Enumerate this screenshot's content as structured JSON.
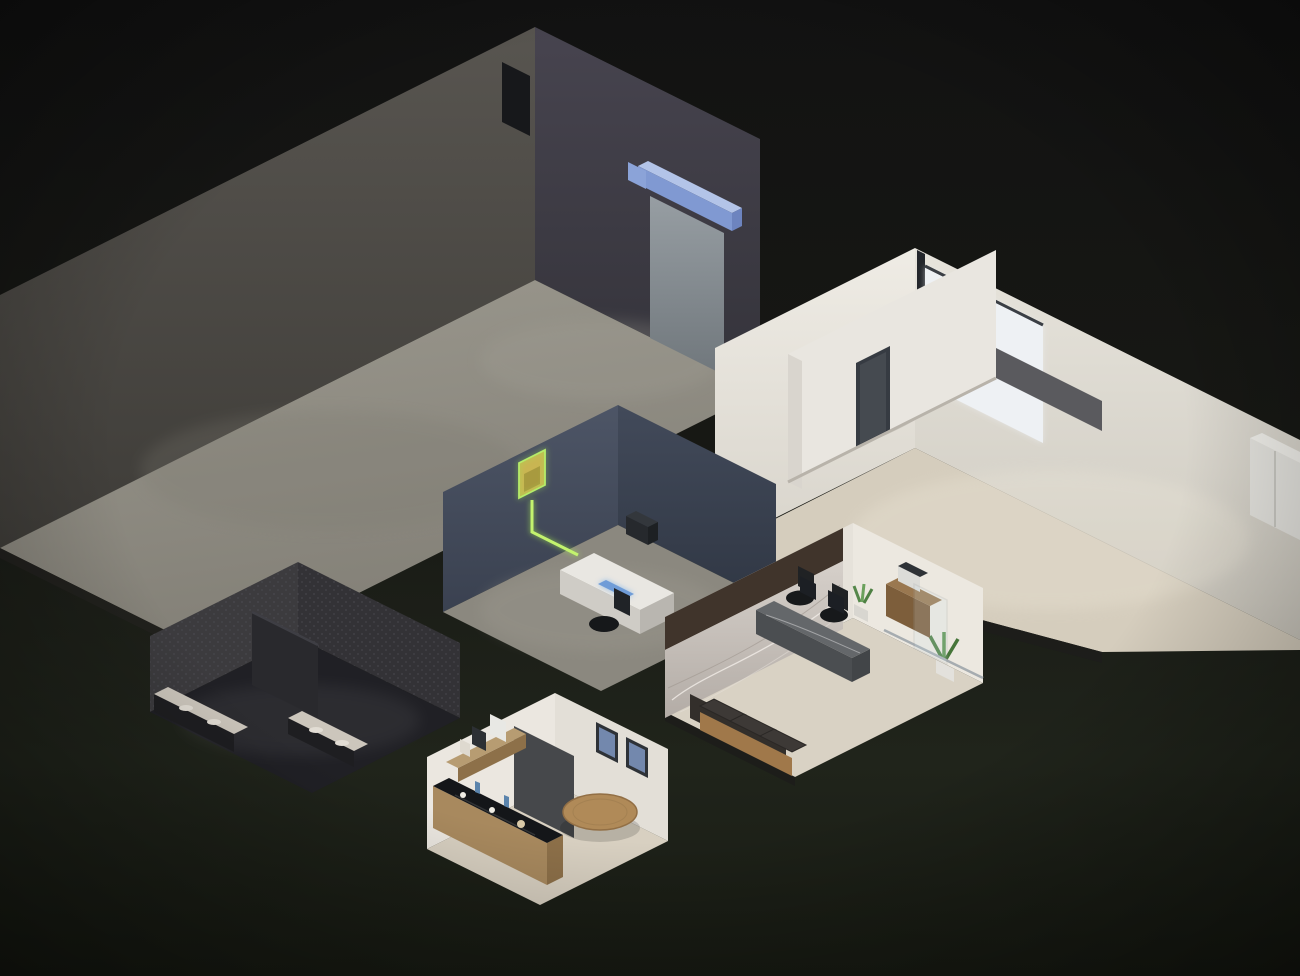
{
  "meta": {
    "type": "isometric-facility-illustration",
    "canvas": {
      "width": 1300,
      "height": 976
    },
    "description": "3D isometric cutaway of a connected facility: warehouse, open office, server room, restrooms, reception and break room linked by glowing green circuit traces on dark ground"
  },
  "palette": {
    "background_top": "#131313",
    "background_mid": "#1a1c16",
    "background_bottom": "#20241b",
    "accent": "#a8e063",
    "outline": "#b9ed6f",
    "trace": "#9fd84f",
    "led": "#f6f0de",
    "light_warm": "#ffefc4",
    "screen_blue": "#9cc8f4",
    "rack_blue": "#3c53b4",
    "rack_orange": "#c96f2d",
    "box_beige": "#c6b9a3",
    "concrete": "#918e85",
    "warehouse_wall": "#4c4a46",
    "office_wall": "#e9e6df",
    "office_floor": "#d5cdbd",
    "server_wall": "#454d5c",
    "cabinet_olive": "#7e8262",
    "bathroom_wall": "#3a393c",
    "bathroom_floor": "#202025",
    "marble_light": "#cdc7c1",
    "wood": "#a8895e",
    "sofa_leather": "#9f7446",
    "slat_brown": "#40342b",
    "door_blue": "#8099d2"
  },
  "rooms": [
    {
      "id": "warehouse",
      "label": "Warehouse",
      "closed": false,
      "outline": [
        [
          0,
          295
        ],
        [
          535,
          27
        ],
        [
          760,
          139
        ],
        [
          760,
          398
        ]
      ]
    },
    {
      "id": "office",
      "label": "Open office",
      "closed": false,
      "outline": [
        [
          790,
          584
        ],
        [
          715,
          548
        ],
        [
          715,
          348
        ],
        [
          915,
          248
        ],
        [
          1298,
          439
        ]
      ]
    },
    {
      "id": "server-room",
      "label": "Server room",
      "closed": true,
      "outline": [
        [
          618,
          405
        ],
        [
          776,
          484
        ],
        [
          776,
          604
        ],
        [
          601,
          691
        ],
        [
          443,
          612
        ],
        [
          443,
          492
        ]
      ]
    },
    {
      "id": "restrooms",
      "label": "Restrooms",
      "closed": true,
      "outline": [
        [
          298,
          562
        ],
        [
          460,
          643
        ],
        [
          460,
          718
        ],
        [
          312,
          793
        ],
        [
          150,
          712
        ],
        [
          150,
          636
        ]
      ]
    },
    {
      "id": "reception",
      "label": "Reception",
      "closed": true,
      "outline": [
        [
          853,
          523
        ],
        [
          983,
          588
        ],
        [
          983,
          683
        ],
        [
          795,
          777
        ],
        [
          665,
          712
        ],
        [
          665,
          617
        ]
      ]
    },
    {
      "id": "break-room",
      "label": "Break room",
      "closed": true,
      "outline": [
        [
          555,
          693
        ],
        [
          668,
          749
        ],
        [
          668,
          841
        ],
        [
          540,
          905
        ],
        [
          427,
          849
        ],
        [
          427,
          757
        ]
      ]
    }
  ],
  "network": {
    "traces": [
      {
        "points": [
          [
            300,
            563
          ],
          [
            460,
            643
          ],
          [
            442,
            652
          ],
          [
            545,
            704
          ]
        ]
      },
      {
        "points": [
          [
            300,
            572
          ],
          [
            442,
            643
          ],
          [
            424,
            652
          ],
          [
            545,
            713
          ]
        ]
      },
      {
        "points": [
          [
            300,
            581
          ],
          [
            424,
            643
          ],
          [
            406,
            652
          ],
          [
            545,
            722
          ]
        ]
      },
      {
        "points": [
          [
            300,
            590
          ],
          [
            406,
            643
          ],
          [
            388,
            652
          ],
          [
            545,
            731
          ]
        ]
      },
      {
        "points": [
          [
            460,
            664
          ],
          [
            512,
            690
          ],
          [
            498,
            697
          ],
          [
            530,
            713
          ]
        ]
      },
      {
        "points": [
          [
            460,
            676
          ],
          [
            504,
            698
          ],
          [
            490,
            705
          ],
          [
            522,
            721
          ]
        ]
      },
      {
        "points": [
          [
            460,
            688
          ],
          [
            496,
            706
          ],
          [
            482,
            713
          ],
          [
            514,
            729
          ]
        ]
      },
      {
        "points": [
          [
            668,
            762
          ],
          [
            792,
            824
          ]
        ]
      },
      {
        "points": [
          [
            668,
            774
          ],
          [
            780,
            830
          ]
        ]
      },
      {
        "points": [
          [
            668,
            786
          ],
          [
            768,
            836
          ]
        ]
      },
      {
        "points": [
          [
            665,
            720
          ],
          [
            665,
            736
          ],
          [
            795,
            801
          ],
          [
            968,
            714
          ]
        ]
      },
      {
        "points": [
          [
            665,
            748
          ],
          [
            795,
            813
          ],
          [
            925,
            748
          ]
        ]
      },
      {
        "points": [
          [
            712,
            893
          ],
          [
            1148,
            675
          ],
          [
            1262,
            732
          ]
        ]
      },
      {
        "points": [
          [
            985,
            622
          ],
          [
            1117,
            688
          ],
          [
            1242,
            625
          ]
        ]
      },
      {
        "points": [
          [
            776,
            492
          ],
          [
            814,
            511
          ]
        ]
      },
      {
        "points": [
          [
            776,
            504
          ],
          [
            808,
            520
          ]
        ]
      }
    ]
  },
  "warehouse": {
    "racks": [
      [
        505,
        291,
        96
      ],
      [
        489,
        329,
        136
      ],
      [
        346,
        386,
        136
      ],
      [
        203,
        443,
        136
      ],
      [
        60,
        500,
        136
      ]
    ],
    "windows_left": {
      "pairs": [
        88,
        278,
        468
      ],
      "half": 75,
      "rows": [
        {
          "t": 36,
          "h": 74
        },
        {
          "t": 140,
          "h": 84
        }
      ]
    },
    "windows_right": {
      "pairs": [
        588
      ],
      "half": 48,
      "rows": [
        {
          "t": 34,
          "h": 66
        },
        {
          "t": 128,
          "h": 76
        }
      ]
    }
  },
  "office": {
    "clusters": [
      [
        962,
        478
      ],
      [
        1094,
        543
      ],
      [
        1126,
        421
      ],
      [
        1256,
        487
      ]
    ],
    "windows": [
      1085,
      1170,
      1255
    ],
    "pictures": [
      744,
      770,
      796
    ],
    "conference_chairs": {
      "blue": [
        [
          826,
          398
        ],
        [
          852,
          385
        ],
        [
          878,
          372
        ],
        [
          904,
          359
        ]
      ],
      "dark": [
        [
          944,
          386
        ],
        [
          818,
          432
        ]
      ]
    }
  },
  "server_room": {
    "cabinets": [
      {
        "x": 452,
        "y": 562,
        "len": 64,
        "h": 80,
        "dir": -1
      },
      {
        "x": 556,
        "y": 512,
        "len": 66,
        "h": 88,
        "dir": -1
      },
      {
        "x": 645,
        "y": 542,
        "len": 56,
        "h": 84,
        "dir": 1
      },
      {
        "x": 703,
        "y": 572,
        "len": 56,
        "h": 84,
        "dir": 1
      }
    ]
  },
  "restrooms": {
    "stalls": [
      {
        "panels": [
          [
            166,
            700
          ],
          [
            212,
            677
          ],
          [
            258,
            654
          ]
        ]
      },
      {
        "panels": [
          [
            308,
            672
          ],
          [
            354,
            649
          ]
        ]
      }
    ],
    "urinals": [
      [
        384,
        684
      ],
      [
        410,
        697
      ],
      [
        436,
        710
      ]
    ]
  },
  "break_room": {
    "chairs": [
      [
        556,
        796
      ],
      [
        622,
        784
      ],
      [
        645,
        820
      ],
      [
        578,
        842
      ]
    ]
  },
  "reception": {
    "glass_posts": [
      [
        884,
        630
      ],
      [
        917,
        646
      ],
      [
        950,
        662
      ],
      [
        982,
        678
      ]
    ]
  },
  "lights": {
    "dots": [
      [
        103,
        300
      ],
      [
        245,
        232
      ],
      [
        378,
        166
      ],
      [
        508,
        100
      ],
      [
        160,
        392
      ],
      [
        300,
        322
      ],
      [
        638,
        160
      ],
      [
        700,
        191
      ],
      [
        765,
        345
      ],
      [
        800,
        328
      ],
      [
        835,
        310
      ],
      [
        868,
        294
      ],
      [
        940,
        296
      ],
      [
        978,
        314
      ],
      [
        1014,
        332
      ],
      [
        1050,
        350
      ],
      [
        855,
        270
      ],
      [
        486,
        466
      ],
      [
        526,
        446
      ],
      [
        566,
        426
      ],
      [
        652,
        452
      ],
      [
        700,
        476
      ],
      [
        744,
        498
      ],
      [
        185,
        620
      ],
      [
        218,
        604
      ],
      [
        251,
        588
      ],
      [
        284,
        571
      ],
      [
        322,
        584
      ],
      [
        352,
        599
      ],
      [
        382,
        614
      ],
      [
        412,
        629
      ],
      [
        442,
        644
      ],
      [
        692,
        596
      ],
      [
        716,
        584
      ],
      [
        740,
        572
      ],
      [
        764,
        560
      ],
      [
        788,
        548
      ],
      [
        812,
        536
      ],
      [
        872,
        556
      ],
      [
        906,
        573
      ],
      [
        940,
        590
      ],
      [
        470,
        738
      ],
      [
        498,
        724
      ],
      [
        526,
        710
      ],
      [
        584,
        710
      ],
      [
        612,
        724
      ],
      [
        640,
        738
      ]
    ],
    "leds": [
      [
        735,
        352,
        905,
        268
      ],
      [
        925,
        270,
        1288,
        450
      ],
      [
        932,
        322,
        1152,
        431
      ],
      [
        748,
        396,
        890,
        325
      ],
      [
        468,
        504,
        598,
        440
      ],
      [
        636,
        450,
        760,
        512
      ],
      [
        688,
        630,
        836,
        556
      ],
      [
        862,
        548,
        974,
        602
      ],
      [
        443,
        752,
        546,
        700
      ],
      [
        560,
        706,
        658,
        755
      ],
      [
        437,
        774,
        518,
        814
      ]
    ]
  }
}
